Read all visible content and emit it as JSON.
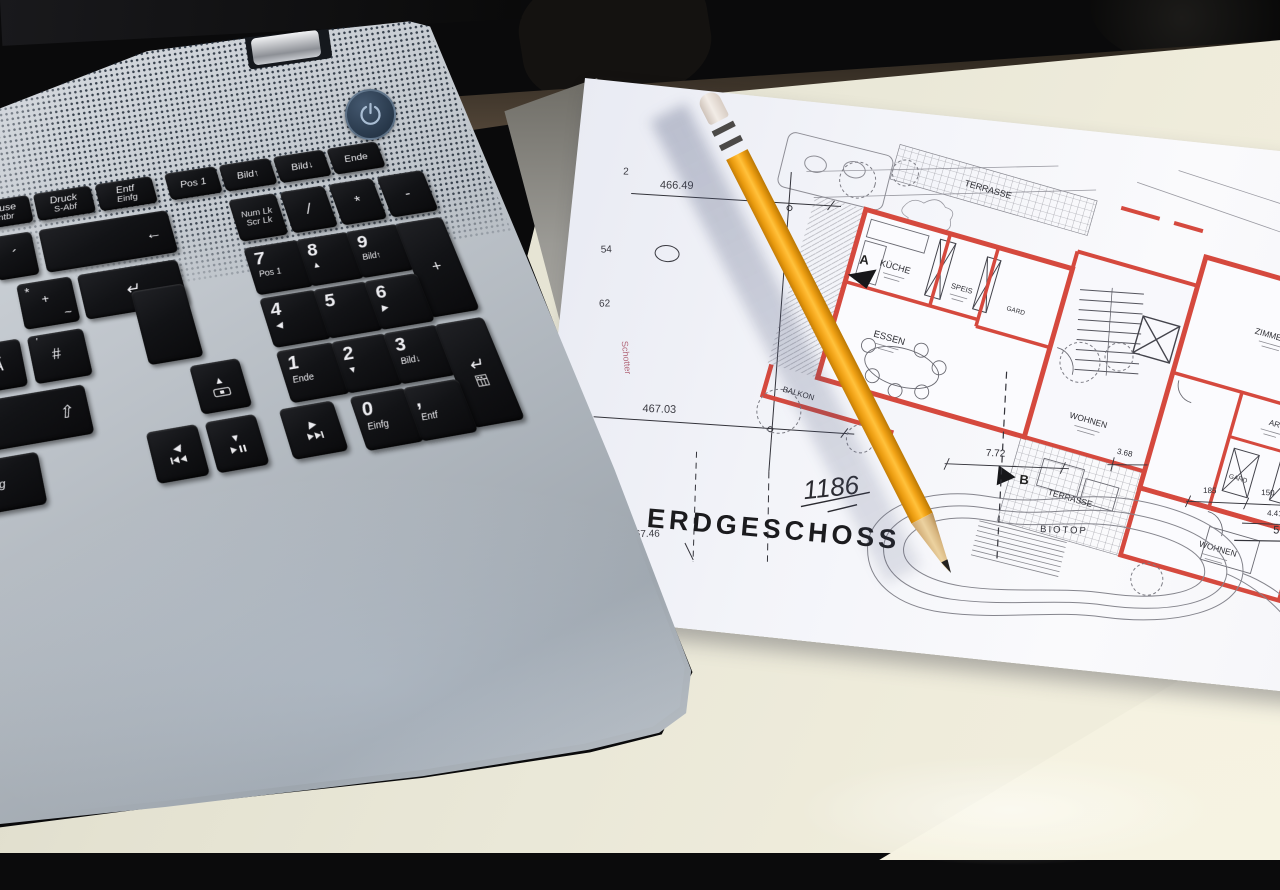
{
  "colors": {
    "laptop_blue": "#5d7089",
    "key_black": "#121316",
    "pencil_orange": "#f3a417",
    "paper_white": "#f3f4f9",
    "plan_wall_red": "#d5493e",
    "plan_line_gray": "#55555e",
    "highlight_green": "#86c46e",
    "table_cream": "#eae8d8",
    "background_black": "#0a0a0b"
  },
  "laptop": {
    "power_button_icon": "power-icon",
    "keyboard": {
      "fn_row": [
        {
          "line1": "Pause",
          "line2": "Untbr"
        },
        {
          "line1": "Druck",
          "line2": "S-Abf"
        },
        {
          "line1": "Entf",
          "line2": "Einfg"
        },
        {
          "line1": "Pos 1"
        },
        {
          "line1": "Bild↑"
        },
        {
          "line1": "Bild↓"
        },
        {
          "line1": "Ende"
        }
      ],
      "main": {
        "acute": "´",
        "backspace": "←",
        "star": "*",
        "plus": "+",
        "tilde": "~",
        "apostrophe": "'",
        "hash": "#",
        "umlaut_a": "Ä",
        "shift": "⇧",
        "strg": "Strg",
        "enter": "↵"
      },
      "arrow_cluster": {
        "up": "▲",
        "left": "◀",
        "down": "▼",
        "right": "▶",
        "up_icon": "touchpad-toggle-icon",
        "left_icon": "previous-track-icon",
        "down_icon": "play-pause-icon",
        "right_icon": "next-track-icon"
      },
      "numpad": {
        "numlk1": "Num Lk",
        "numlk2": "Scr Lk",
        "divide": "/",
        "multiply": "*",
        "minus": "-",
        "plus": "+",
        "enter": "↵",
        "enter_icon": "calc-grid-icon",
        "k7": {
          "d": "7",
          "s": "Pos 1"
        },
        "k8": {
          "d": "8",
          "s": "▲"
        },
        "k9": {
          "d": "9",
          "s": "Bild↑"
        },
        "k4": {
          "d": "4",
          "s": "◀"
        },
        "k5": {
          "d": "5",
          "s": ""
        },
        "k6": {
          "d": "6",
          "s": "▶"
        },
        "k1": {
          "d": "1",
          "s": "Ende"
        },
        "k2": {
          "d": "2",
          "s": "▼"
        },
        "k3": {
          "d": "3",
          "s": "Bild↓"
        },
        "k0": {
          "d": "0",
          "s": "Einfg"
        },
        "comma": {
          "d": ",",
          "s": "Entf"
        }
      }
    }
  },
  "plan": {
    "title": "ERDGESCHOSS",
    "sheet_number": "1186",
    "site_note": "Schotter",
    "elevations": {
      "e2": "2",
      "e46649": "466.49",
      "e54": "54",
      "e62": "62",
      "e46703": "467.03",
      "e5710": "57.10",
      "e46736": "467.36",
      "e46746": "467.46"
    },
    "dimensions": {
      "d772": "7.72",
      "d368": "3.68",
      "d185": "185",
      "d150": "150",
      "d441": "4.41",
      "d520": "5.20"
    },
    "section_markers": {
      "a": "A",
      "b": "B"
    },
    "rooms": {
      "terrasse_top": "TERRASSE",
      "kueche": "KÜCHE",
      "speis": "SPEIS",
      "gard_links": "GARD",
      "essen": "ESSEN",
      "balkon": "BALKON",
      "wohnen_mitte": "WOHNEN",
      "zimmer1": "ZIMMER 1",
      "ar": "AR",
      "gard_rechts": "GARD",
      "wc": "WC",
      "wohnen_rechts": "WOHNEN",
      "terrasse_unten": "TERRASSE",
      "biotop": "BIOTOP"
    }
  }
}
